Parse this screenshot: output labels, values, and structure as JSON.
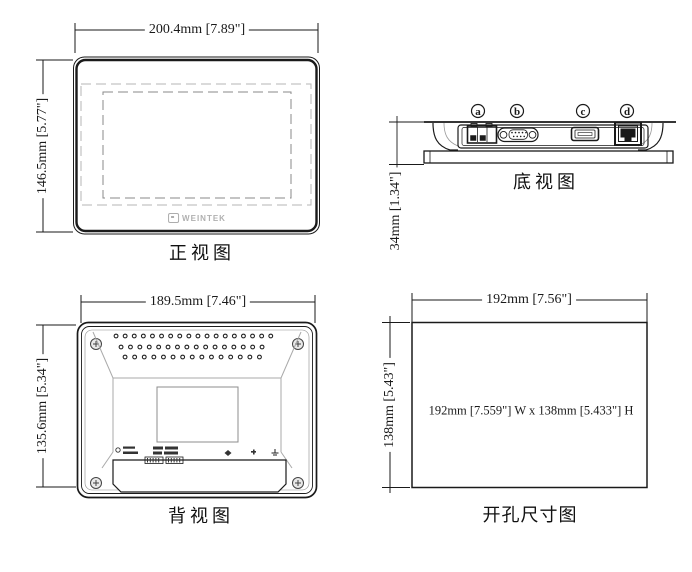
{
  "drawing_title": "HMI panel dimension drawing",
  "views": {
    "front": {
      "label": "正视图",
      "dim_width": "200.4mm [7.89\"]",
      "dim_height": "146.5mm [5.77\"]",
      "logo": "WEINTEK"
    },
    "bottom": {
      "label": "底视图",
      "dim_height": "34mm [1.34\"]",
      "ports": [
        {
          "id": "a",
          "name": "power-terminal"
        },
        {
          "id": "b",
          "name": "serial-db9"
        },
        {
          "id": "c",
          "name": "usb-port"
        },
        {
          "id": "d",
          "name": "ethernet-port"
        }
      ]
    },
    "back": {
      "label": "背视图",
      "dim_width": "189.5mm [7.46\"]",
      "dim_height": "135.6mm [5.34\"]"
    },
    "cutout": {
      "label": "开孔尺寸图",
      "dim_width": "192mm [7.56\"]",
      "dim_height": "138mm [5.43\"]",
      "note": "192mm [7.559\"] W x 138mm [5.433\"] H"
    }
  },
  "colors": {
    "line": "#1a1a1a",
    "dashed_outer": "#b5b5b5",
    "dashed_inner": "#8a8a8a",
    "mold_gray": "#aaaaaa",
    "logo_gray": "#b0b0b0",
    "background": "#ffffff"
  }
}
